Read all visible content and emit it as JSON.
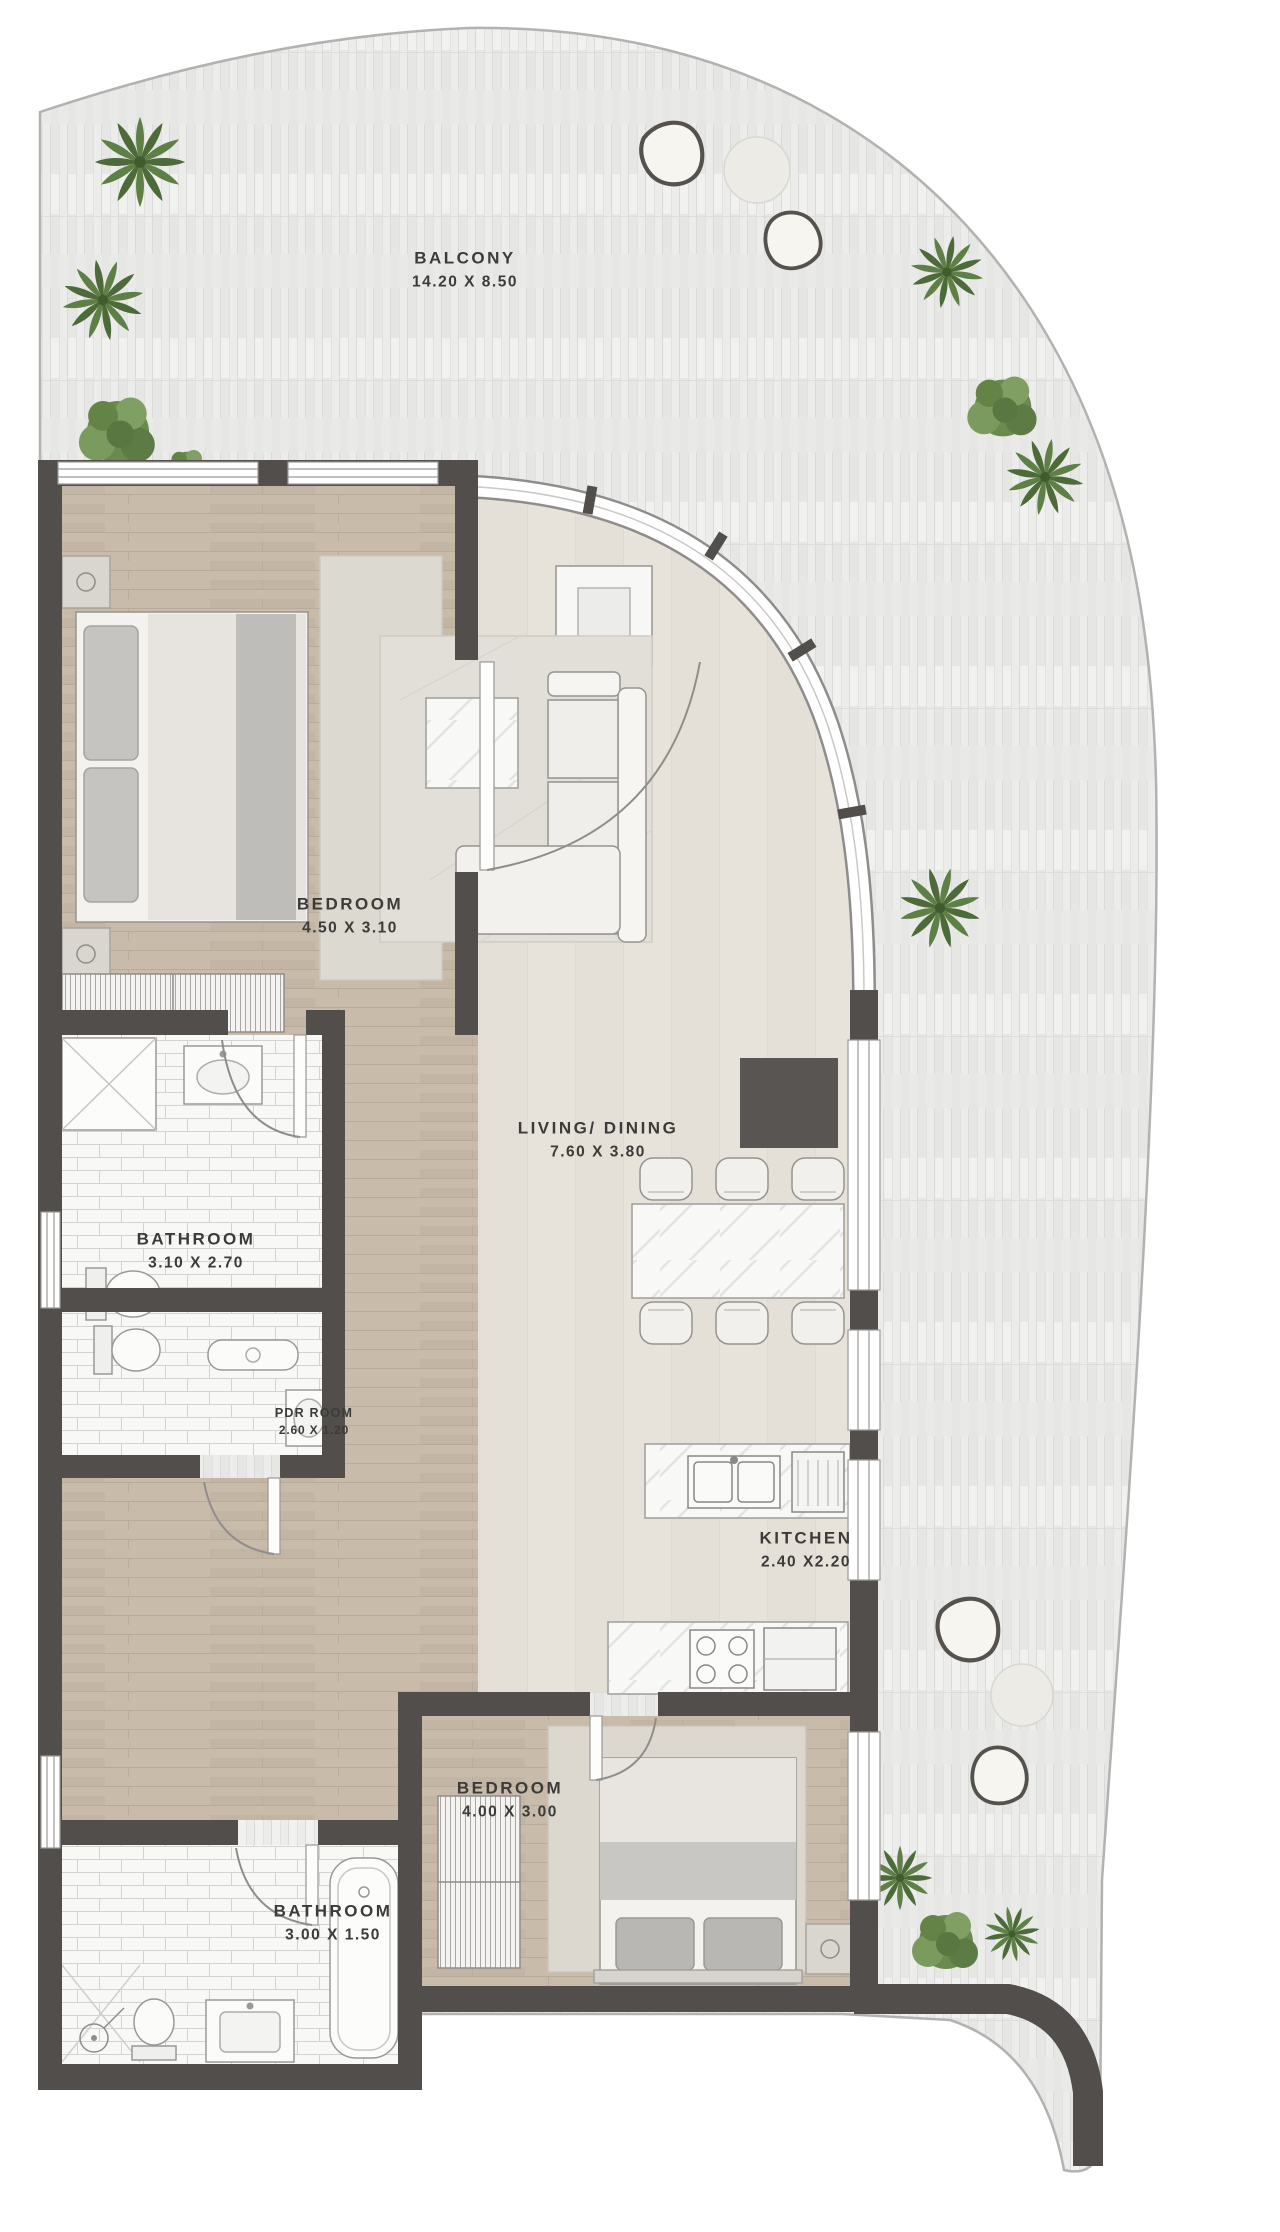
{
  "plan": {
    "title": "apartment floor plan",
    "rooms": [
      {
        "id": "balcony",
        "label": "BALCONY",
        "dimensions": "14.20 X 8.50"
      },
      {
        "id": "bedroom-1",
        "label": "BEDROOM",
        "dimensions": "4.50 X 3.10"
      },
      {
        "id": "bathroom-1",
        "label": "BATHROOM",
        "dimensions": "3.10 X 2.70"
      },
      {
        "id": "pdr-room",
        "label": "PDR ROOM",
        "dimensions": "2.60 X 1.20"
      },
      {
        "id": "living-dining",
        "label": "LIVING/ DINING",
        "dimensions": "7.60 X 3.80"
      },
      {
        "id": "kitchen",
        "label": "KITCHEN",
        "dimensions": "2.40 X2.20"
      },
      {
        "id": "bedroom-2",
        "label": "BEDROOM",
        "dimensions": "4.00 X 3.00"
      },
      {
        "id": "bathroom-2",
        "label": "BATHROOM",
        "dimensions": "3.00 X 1.50"
      }
    ],
    "icons": {
      "tree_palm": "palm-tree-icon",
      "tree_bush": "bush-tree-icon",
      "bean_bag": "bean-bag-chair-icon",
      "door": "door-swing-icon",
      "window": "window-icon"
    },
    "colors": {
      "wall": "#514e4b",
      "wood_floor": "#c8b9a8",
      "living_floor": "#e6e2da",
      "balcony_deck": "#ebece9",
      "tile": "#f7f7f5",
      "tree_green": "#5e8046"
    }
  }
}
